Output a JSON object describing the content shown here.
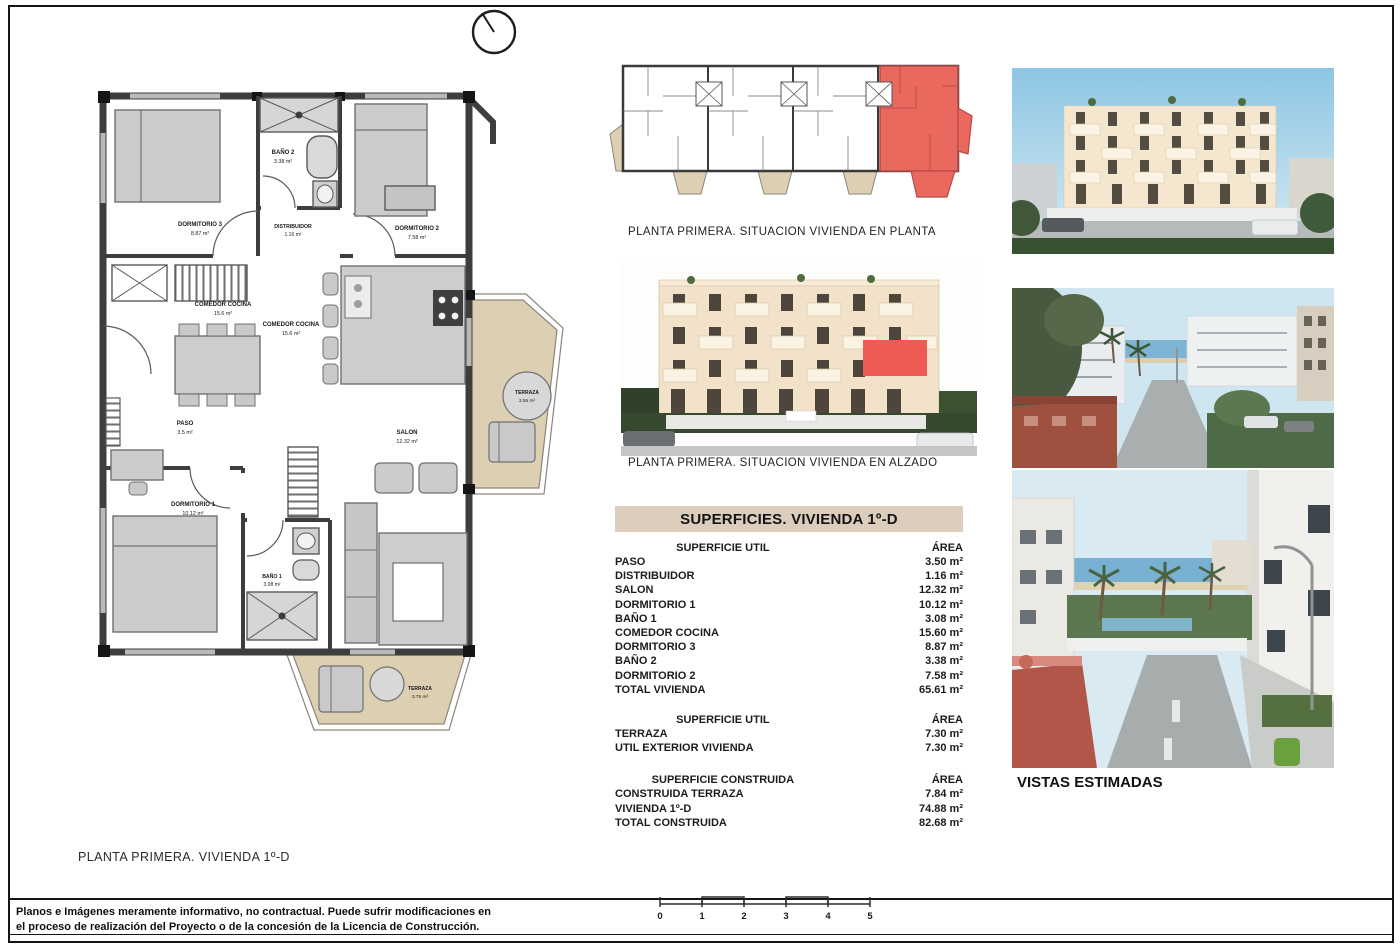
{
  "colors": {
    "highlight_red": "#e9695f",
    "terrace_beige": "#dccfb2",
    "table_header_beige": "#dccdbd"
  },
  "floorplan": {
    "rooms": [
      {
        "name": "DORMITORIO 3",
        "area": "8.87 m²"
      },
      {
        "name": "BAÑO 2",
        "area": "3.38 m²"
      },
      {
        "name": "DORMITORIO 2",
        "area": "7.58 m²"
      },
      {
        "name": "DISTRIBUIDOR",
        "area": "1.16 m²"
      },
      {
        "name": "COMEDOR COCINA",
        "area": "15.6 m²"
      },
      {
        "name": "PASO",
        "area": "3.5 m²"
      },
      {
        "name": "SALON",
        "area": "12.32 m²"
      },
      {
        "name": "DORMITORIO 1",
        "area": "10.12 m²"
      },
      {
        "name": "BAÑO 1",
        "area": "3.08 m²"
      },
      {
        "name": "TERRAZA",
        "area": "3.55 m²"
      },
      {
        "name": "TERRAZA",
        "area": "3.75 m²"
      }
    ]
  },
  "captions": {
    "site_plan": "PLANTA PRIMERA. SITUACION VIVIENDA EN PLANTA",
    "elevation": "PLANTA PRIMERA. SITUACION VIVIENDA EN ALZADO",
    "views": "VISTAS ESTIMADAS",
    "sheet": "PLANTA PRIMERA. VIVIENDA 1º-D"
  },
  "surfaces": {
    "title": "SUPERFICIES. VIVIENDA 1º-D",
    "sections": [
      {
        "header": "SUPERFICIE UTIL",
        "area_header": "ÁREA",
        "rows": [
          {
            "label": "PASO",
            "value": "3.50 m²"
          },
          {
            "label": "DISTRIBUIDOR",
            "value": "1.16 m²"
          },
          {
            "label": "SALON",
            "value": "12.32 m²"
          },
          {
            "label": "DORMITORIO 1",
            "value": "10.12 m²"
          },
          {
            "label": "BAÑO 1",
            "value": "3.08 m²"
          },
          {
            "label": "COMEDOR COCINA",
            "value": "15.60 m²"
          },
          {
            "label": "DORMITORIO 3",
            "value": "8.87 m²"
          },
          {
            "label": "BAÑO 2",
            "value": "3.38 m²"
          },
          {
            "label": "DORMITORIO 2",
            "value": "7.58 m²"
          },
          {
            "label": "TOTAL VIVIENDA",
            "value": "65.61 m²"
          }
        ]
      },
      {
        "header": "SUPERFICIE UTIL",
        "area_header": "ÁREA",
        "rows": [
          {
            "label": "TERRAZA",
            "value": "7.30 m²"
          },
          {
            "label": "UTIL EXTERIOR VIVIENDA",
            "value": "7.30 m²"
          }
        ]
      },
      {
        "header": "SUPERFICIE CONSTRUIDA",
        "area_header": "ÁREA",
        "rows": [
          {
            "label": "CONSTRUIDA TERRAZA",
            "value": "7.84 m²"
          },
          {
            "label": "VIVIENDA 1º-D",
            "value": "74.88 m²"
          },
          {
            "label": "TOTAL CONSTRUIDA",
            "value": "82.68 m²"
          }
        ]
      }
    ]
  },
  "scalebar": {
    "labels": [
      "0",
      "1",
      "2",
      "3",
      "4",
      "5"
    ]
  },
  "footer": {
    "line1": "Planos e Imágenes meramente informativo, no contractual. Puede sufrir modificaciones en",
    "line2": "el proceso de realización del Proyecto o de la concesión de la Licencia de Construcción."
  }
}
